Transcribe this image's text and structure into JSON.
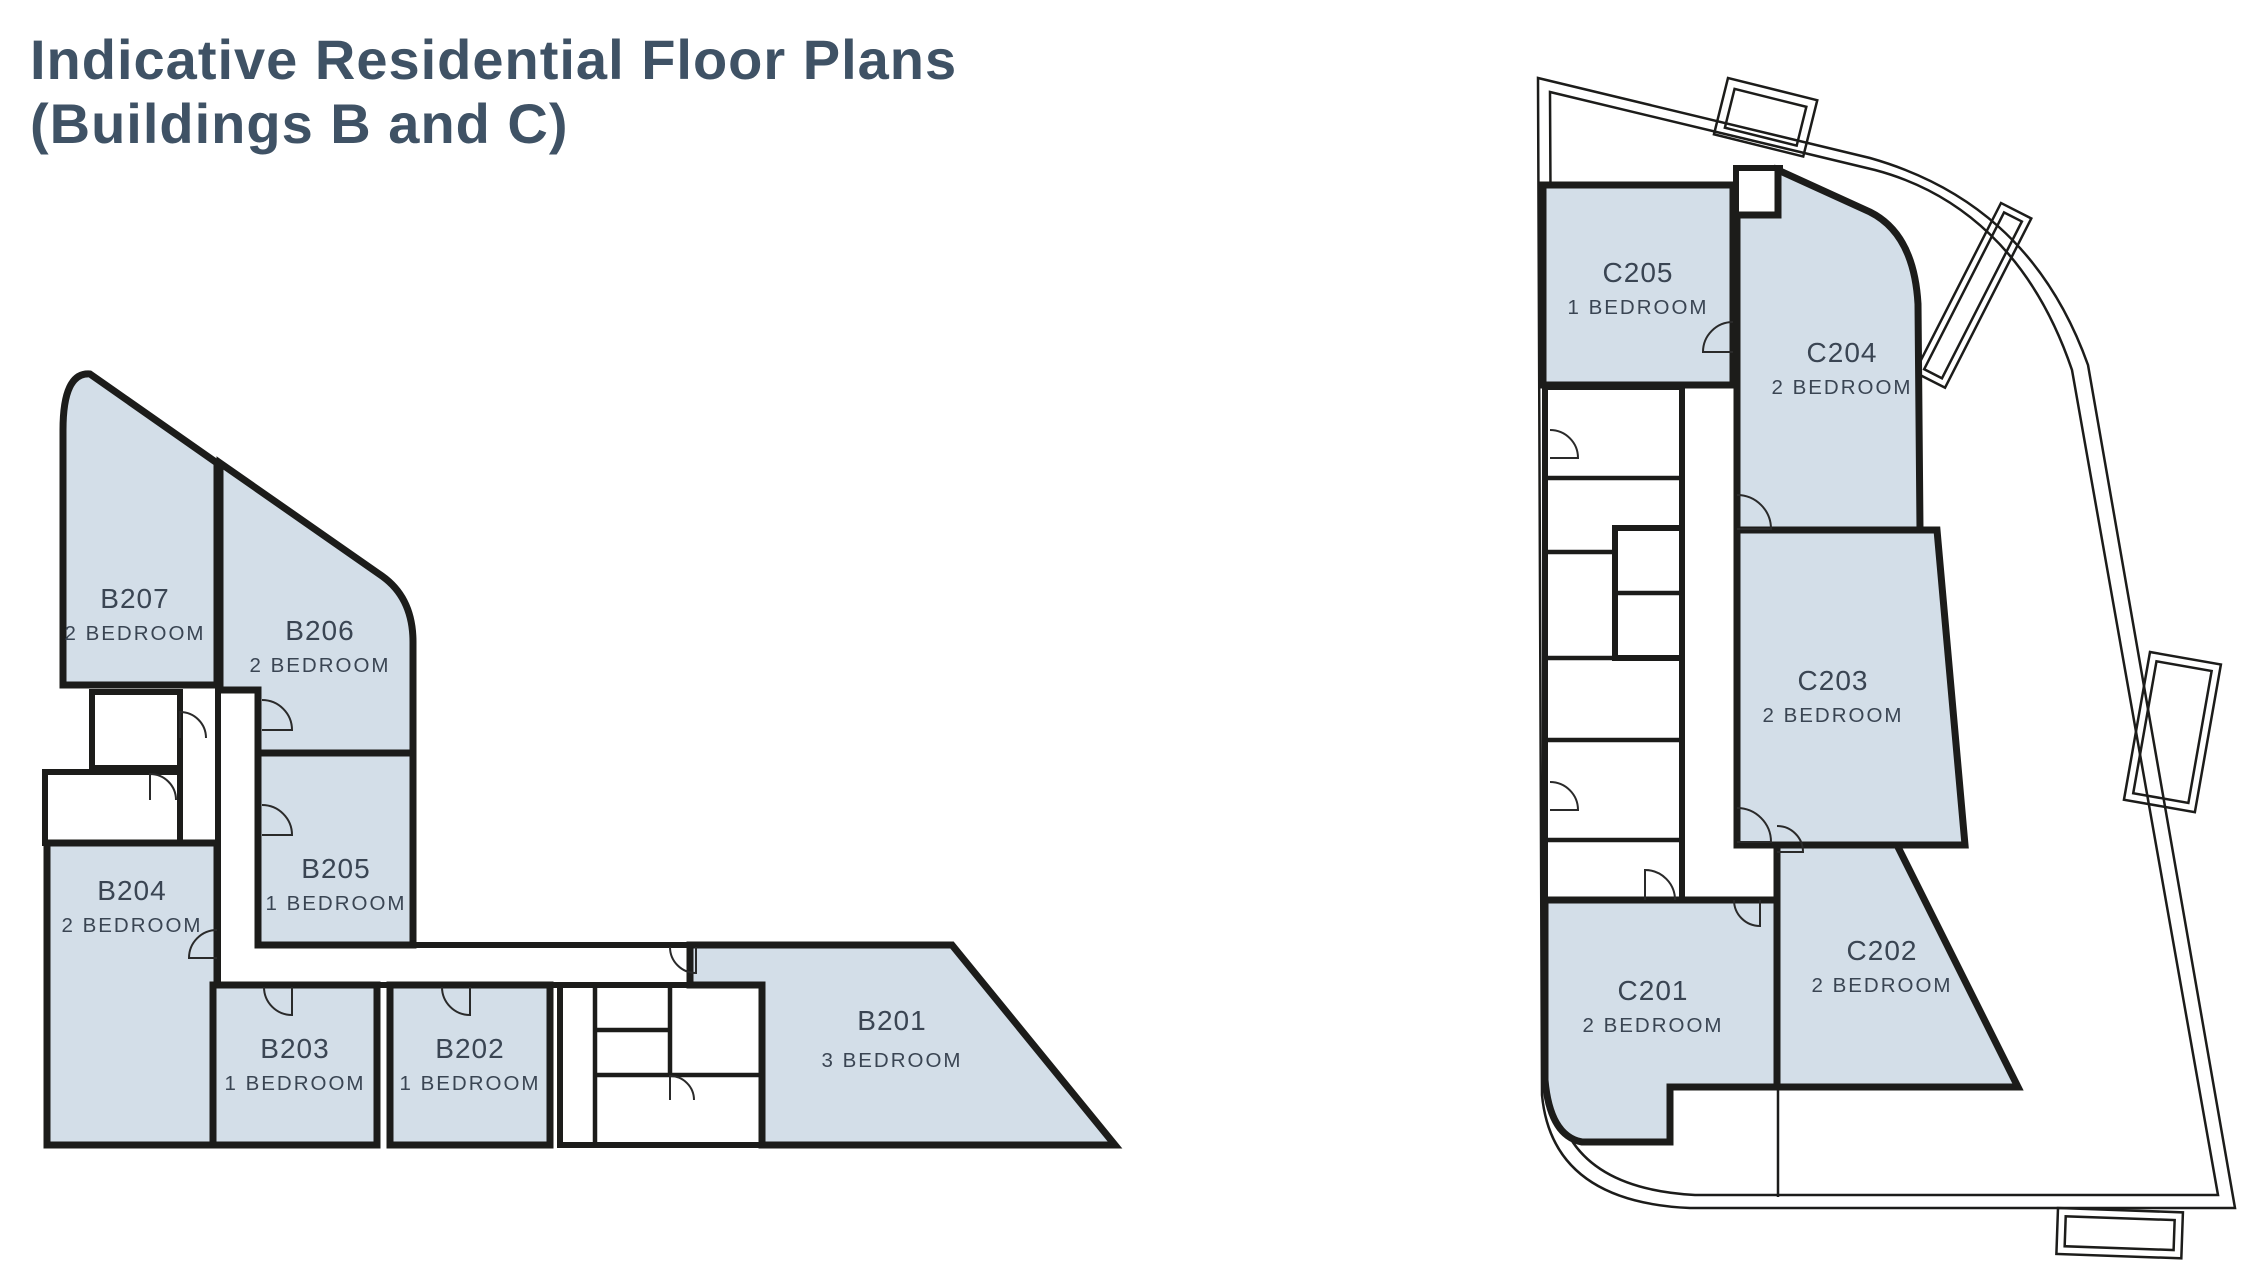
{
  "title": {
    "line1": "Indicative Residential Floor Plans",
    "line2": "(Buildings B and C)"
  },
  "colors": {
    "background": "#ffffff",
    "room_fill": "#d3dee8",
    "wall": "#1c1c1a",
    "title_text": "#3f5265",
    "label_text": "#3a4553"
  },
  "building_b": {
    "rooms": [
      {
        "unit": "B207",
        "type": "2 BEDROOM"
      },
      {
        "unit": "B206",
        "type": "2 BEDROOM"
      },
      {
        "unit": "B205",
        "type": "1 BEDROOM"
      },
      {
        "unit": "B204",
        "type": "2 BEDROOM"
      },
      {
        "unit": "B203",
        "type": "1 BEDROOM"
      },
      {
        "unit": "B202",
        "type": "1 BEDROOM"
      },
      {
        "unit": "B201",
        "type": "3 BEDROOM"
      }
    ]
  },
  "building_c": {
    "rooms": [
      {
        "unit": "C205",
        "type": "1 BEDROOM"
      },
      {
        "unit": "C204",
        "type": "2 BEDROOM"
      },
      {
        "unit": "C203",
        "type": "2 BEDROOM"
      },
      {
        "unit": "C202",
        "type": "2 BEDROOM"
      },
      {
        "unit": "C201",
        "type": "2 BEDROOM"
      }
    ]
  }
}
